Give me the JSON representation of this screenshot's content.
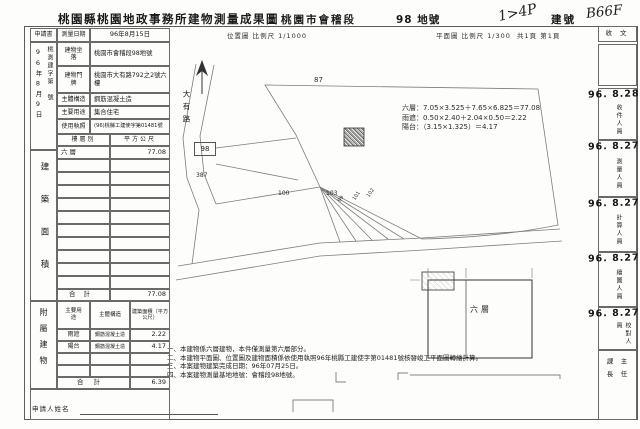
{
  "header": {
    "title": "桃園縣桃園地政事務所建物測量成果圖",
    "district": "桃園市會稽段",
    "lot_no": "98 地號",
    "handwritten_mark": "1>4P",
    "building_no_label": "建號",
    "building_no_handwritten": "B66F"
  },
  "top_row": {
    "applicant_label": "申請書",
    "survey_date_label": "測量日期",
    "survey_date_value": "96年8月15日",
    "position_map_scale": "位置圖 比例尺 1/1000",
    "plan_scale": "平面圖 比例尺 1/300",
    "page_info": "共1頁 第1頁",
    "receive_doc_label": "收 文"
  },
  "receipt": {
    "date_vertical": "96年8月9日",
    "doc_no_vertical": "桃測建字第　號"
  },
  "form": {
    "rows": [
      {
        "label": "建物坐落",
        "value": "桃園市會稽段98地號"
      },
      {
        "label": "建物門牌",
        "value": "桃園市大有路792之2號六樓"
      },
      {
        "label": "主體構造",
        "value": "鋼筋混凝土造"
      },
      {
        "label": "主要用途",
        "value": "集合住宅"
      },
      {
        "label": "使用執照",
        "value": "(96)桃縣工建使字第01481號"
      }
    ],
    "building_area_label": "建築面積",
    "floor_table": {
      "col_floor": "樓層別",
      "col_area": "平方公尺",
      "rows": [
        {
          "floor": "六層",
          "area": "77.08"
        }
      ],
      "total_label": "合計",
      "total_value": "77.08"
    },
    "annex_label": "附屬建物",
    "annex_table": {
      "col_use": "主要用途",
      "col_structure": "主體構造",
      "col_area": "建築面積（平方公尺）",
      "rows": [
        {
          "use": "雨遮",
          "structure": "鋼筋混凝土造",
          "area": "2.22"
        },
        {
          "use": "陽台",
          "structure": "鋼筋混凝土造",
          "area": "4.17"
        }
      ],
      "total_label": "合計",
      "total_value": "6.39"
    },
    "applicant_name_label": "申請人姓名"
  },
  "map": {
    "road_name": "大有路",
    "lots": [
      "87",
      "98",
      "387",
      "100",
      "103",
      "99",
      "101",
      "102"
    ],
    "plan_floor_label": "六層",
    "calculations": [
      "六層：7.05×3.525＋7.65×6.825＝77.08",
      "雨遮：0.50×2.40＋2.04×0.50＝2.22",
      "陽台：（3.15×1.325）＝4.17"
    ]
  },
  "notes": [
    "一、本建物係六層建物，本件僅測量第六層部分。",
    "二、本建物平面圖、位置圖及建物面積係依使用執照96年桃縣工建使字第01481號核發竣工平面圖轉繪計算。",
    "三、本案建物建築完成日期：96年07月25日。",
    "四、本案建物測量基地地號：會稽段98地號。"
  ],
  "sidebar": {
    "stamps": [
      {
        "date": "96. 8.28",
        "label": "收件人員"
      },
      {
        "date": "96. 8.27",
        "label": "測量人員"
      },
      {
        "date": "96. 8.27",
        "label": "計算人員"
      },
      {
        "date": "96. 8.27",
        "label": "繪圖人員"
      },
      {
        "date": "96. 8.27",
        "label": "校對人員"
      }
    ],
    "approval_right": "主任",
    "approval_left": "課長"
  }
}
